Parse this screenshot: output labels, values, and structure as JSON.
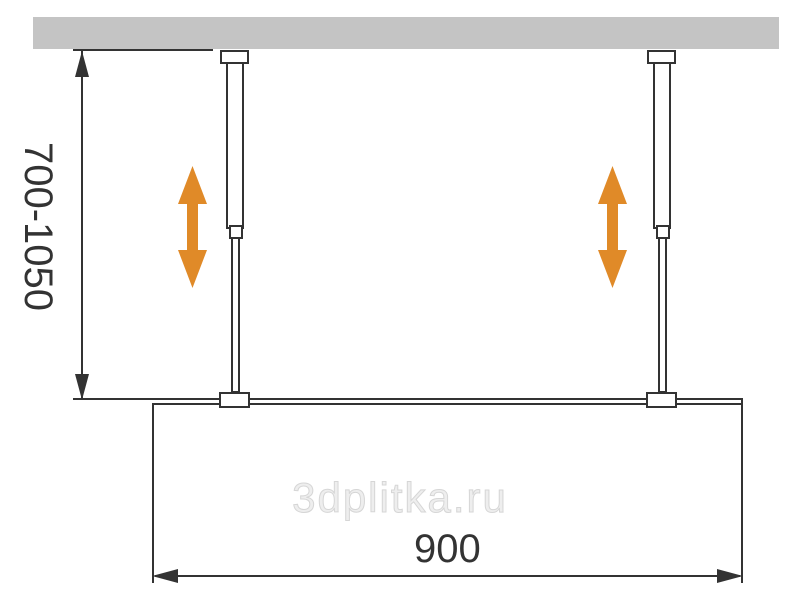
{
  "diagram": {
    "title": "shower-screen-ceiling-rod-installation-drawing",
    "watermark": "3dplitka.ru",
    "dimensions": {
      "height_range": {
        "label": "700-1050",
        "orientation": "vertical",
        "unit": "mm"
      },
      "width": {
        "label": "900",
        "orientation": "horizontal",
        "unit": "mm"
      }
    },
    "icons": {
      "left_adjust_arrow": "double-vertical-arrow-icon",
      "right_adjust_arrow": "double-vertical-arrow-icon",
      "dimension_arrowheads": [
        "arrowhead-up-icon",
        "arrowhead-down-icon",
        "arrowhead-left-icon",
        "arrowhead-right-icon"
      ]
    },
    "colors": {
      "ceiling": "#c4c4c4",
      "line": "#333333",
      "accent_arrow": "#e08a28",
      "watermark": "#d6d6d6",
      "background": "#ffffff"
    }
  }
}
